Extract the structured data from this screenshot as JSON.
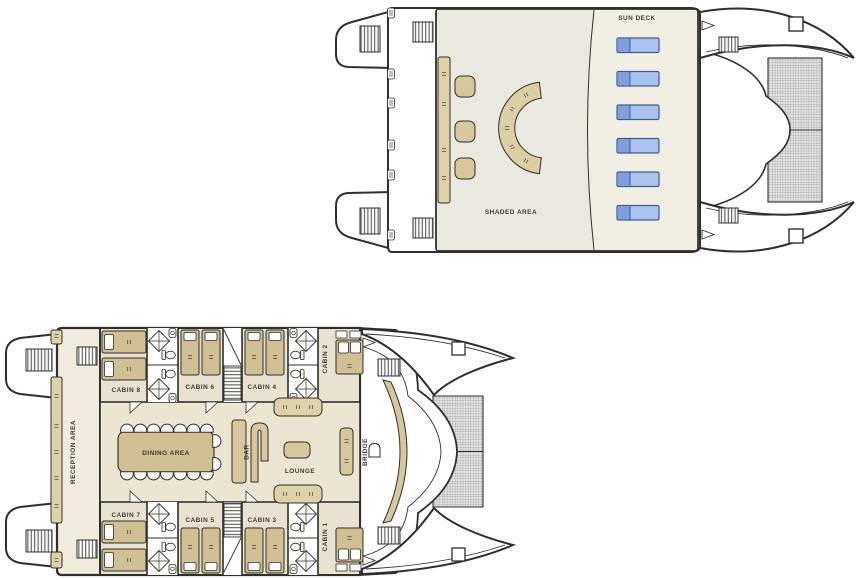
{
  "upper_deck": {
    "sun_deck_label": "SUN DECK",
    "shaded_area_label": "SHADED AREA",
    "lounger_count": 6
  },
  "lower_deck": {
    "reception_label": "RECEPTION AREA",
    "dining_label": "DINING AREA",
    "bar_label": "BAR",
    "lounge_label": "LOUNGE",
    "bridge_label": "BRIDGE",
    "cabins_top": [
      "CABIN 8",
      "CABIN 6",
      "CABIN 4",
      "CABIN 2"
    ],
    "cabins_bottom": [
      "CABIN 7",
      "CABIN 5",
      "CABIN 3",
      "CABIN 1"
    ],
    "cabin_count": 8,
    "dining_chair_count": 16
  },
  "colors": {
    "outline": "#2f2f2b",
    "deck": "#f1efe4",
    "shaded_deck": "#eae9e0",
    "cabin_floor": "#e9e2d0",
    "common_floor": "#ece5d2",
    "corridor_floor": "#f0ebdd",
    "furniture": "#d8c79c",
    "bed": "#d0bf92",
    "bench": "#e0d2a8",
    "lounger_border": "#46598c",
    "lounger_dark": "#7e9edd",
    "lounger_light": "#a9c2ee",
    "net": "#e3e3e1"
  }
}
